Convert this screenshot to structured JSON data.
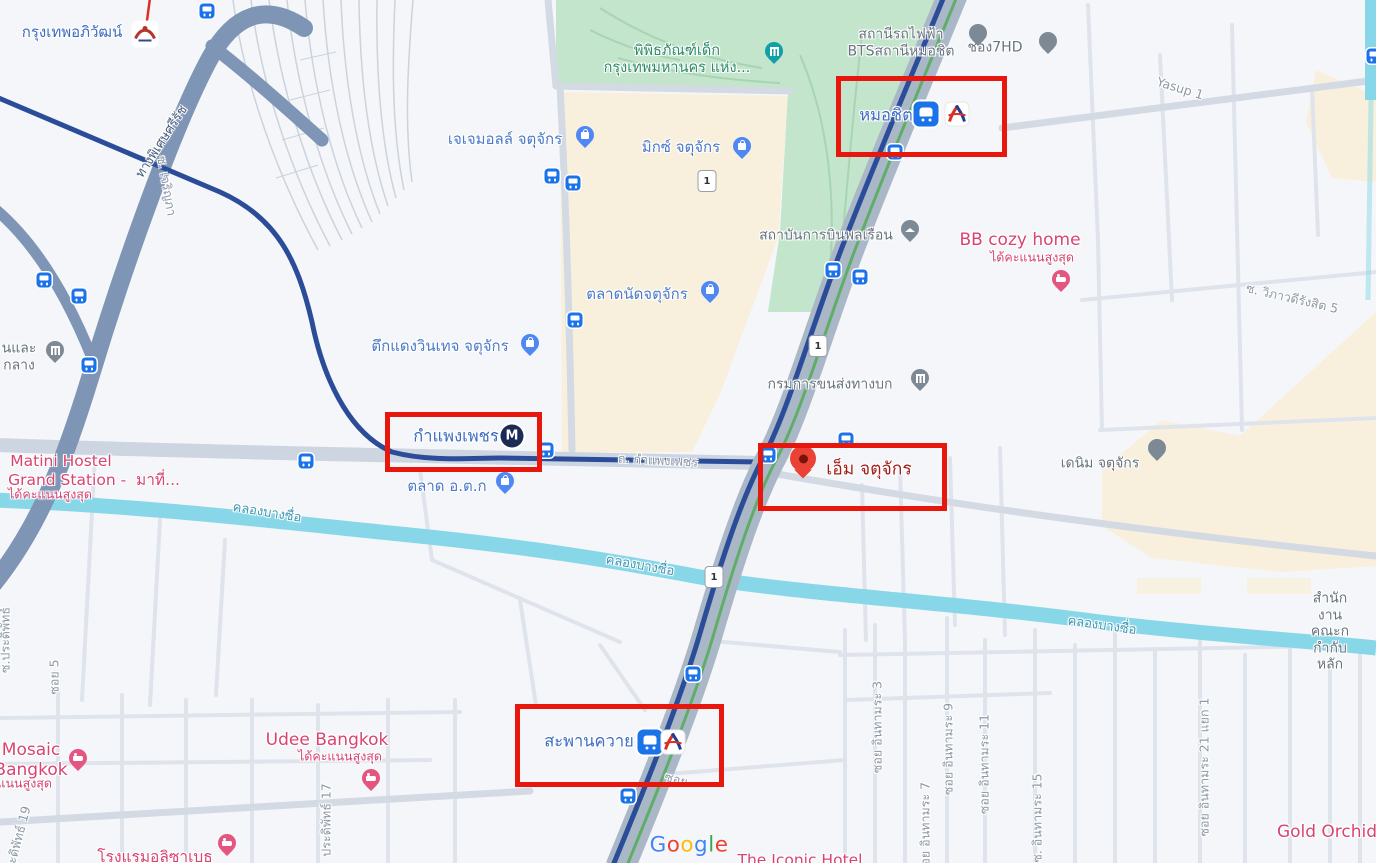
{
  "map": {
    "app": "Google Maps",
    "colors": {
      "annotation_red": "#e8170d",
      "water": "#87d7e8",
      "park_green": "#c2e5cb",
      "market_beige": "#f8f0dc",
      "transit_corridor": "#aab7c7",
      "metro_line": "#2b4d99",
      "bts_green_track": "#5fae67",
      "expressway": "#7e95b5",
      "poi_blue": "#4c7ac6",
      "poi_gray": "#67737e",
      "hotel_pink": "#d84471",
      "selected_pin_red": "#ea4335",
      "bus_stop_blue": "#1a73e8"
    },
    "google_logo": {
      "letters": [
        {
          "ch": "G",
          "color": "#4285F4"
        },
        {
          "ch": "o",
          "color": "#EA4335"
        },
        {
          "ch": "o",
          "color": "#FBBC05"
        },
        {
          "ch": "g",
          "color": "#4285F4"
        },
        {
          "ch": "l",
          "color": "#34A853"
        },
        {
          "ch": "e",
          "color": "#EA4335"
        }
      ]
    },
    "labels": [
      {
        "name": "label-krung-thep-aphiwat-station",
        "text": "กรุงเทพอภิวัฒน์",
        "x": 72,
        "y": 33,
        "cls": "sta15",
        "interact": true
      },
      {
        "name": "label-bts-mochit-station-poi",
        "text": "สถานีรถไฟฟ้า\nBTSสถานีหมอชิต",
        "x": 901,
        "y": 43,
        "cls": "gray",
        "interact": true
      },
      {
        "name": "label-channel-7hd",
        "text": "ช่อง7HD",
        "x": 995,
        "y": 48,
        "cls": "gray",
        "interact": true
      },
      {
        "name": "label-children-museum",
        "text": "พิพิธภัณฑ์เด็ก\nกรุงเทพมหานคร แห่ง...",
        "x": 677,
        "y": 60,
        "cls": "park",
        "interact": true
      },
      {
        "name": "label-yasup-1-road",
        "text": "Yasup 1",
        "x": 1180,
        "y": 89,
        "cls": "road",
        "rot": 17,
        "interact": false
      },
      {
        "name": "label-mochit-bts",
        "text": "หมอชิต",
        "x": 886,
        "y": 115,
        "cls": "sta16",
        "interact": true
      },
      {
        "name": "label-expressway-si-rat",
        "text": "ทางพิเศษศรีรัช",
        "x": 162,
        "y": 142,
        "cls": "exp",
        "rot": -57,
        "interact": false
      },
      {
        "name": "label-jj-mall",
        "text": "เจเจมอลล์ จตุจักร",
        "x": 505,
        "y": 140,
        "cls": "shop",
        "interact": true
      },
      {
        "name": "label-mixt-chatuchak",
        "text": "มิกซ์ จตุจักร",
        "x": 681,
        "y": 148,
        "cls": "shop",
        "interact": true
      },
      {
        "name": "label-soi-charoenpha",
        "text": "ซ. เจริญภา",
        "x": 166,
        "y": 186,
        "cls": "road",
        "rot": 80,
        "interact": false
      },
      {
        "name": "label-civil-aviation-institute",
        "text": "สถาบันการบินพลเรือน",
        "x": 826,
        "y": 236,
        "cls": "gray",
        "interact": true
      },
      {
        "name": "label-bb-cozy-home",
        "text": "BB cozy home",
        "x": 1020,
        "y": 240,
        "cls": "pink17",
        "interact": true
      },
      {
        "name": "label-bb-cozy-home-rating",
        "text": "ได้คะแนนสูงสุด",
        "x": 1032,
        "y": 258,
        "cls": "pinksub",
        "interact": false
      },
      {
        "name": "label-chatuchak-weekend-market",
        "text": "ตลาดนัดจตุจักร",
        "x": 637,
        "y": 295,
        "cls": "shop",
        "interact": true
      },
      {
        "name": "label-soi-wiphawadi-rangsit-5",
        "text": "ซ. วิภาวดีรังสิต 5",
        "x": 1292,
        "y": 299,
        "cls": "road",
        "rot": 13,
        "interact": false
      },
      {
        "name": "label-tuk-daeng-vintage",
        "text": "ตึกแดงวินเทจ จตุจักร",
        "x": 440,
        "y": 347,
        "cls": "shop",
        "interact": true
      },
      {
        "name": "label-bank-truncated",
        "text": "นและ\nกลาง",
        "x": 19,
        "y": 357,
        "cls": "gray",
        "interact": false
      },
      {
        "name": "label-dept-land-transport",
        "text": "กรมการขนส่งทางบก",
        "x": 830,
        "y": 385,
        "cls": "gray",
        "interact": true
      },
      {
        "name": "label-kamphaeng-phet-mrt",
        "text": "กำแพงเพชร",
        "x": 456,
        "y": 436,
        "cls": "sta16",
        "interact": true
      },
      {
        "name": "label-denim-chatuchak",
        "text": "เดนิม จตุจักร",
        "x": 1100,
        "y": 464,
        "cls": "gray",
        "interact": true
      },
      {
        "name": "label-kamphaeng-phet-road",
        "text": "ถ. กำแพงเพชร",
        "x": 658,
        "y": 461,
        "cls": "road",
        "rot": 3,
        "interact": false
      },
      {
        "name": "label-m-chatuchak",
        "text": "เอ็ม จตุจักร",
        "x": 869,
        "y": 470,
        "cls": "darkred",
        "interact": true
      },
      {
        "name": "label-matini-hostel-line1",
        "text": "Matini Hostel",
        "x": 61,
        "y": 461,
        "cls": "pink16",
        "interact": true
      },
      {
        "name": "label-matini-hostel-line2",
        "text": "Grand Station -  มาที่...",
        "x": 94,
        "y": 480,
        "cls": "pink16",
        "interact": true
      },
      {
        "name": "label-matini-hostel-rating",
        "text": "ได้คะแนนสูงสุด",
        "x": 50,
        "y": 495,
        "cls": "pinksub",
        "interact": false
      },
      {
        "name": "label-or-tor-kor-market",
        "text": "ตลาด อ.ต.ก",
        "x": 447,
        "y": 487,
        "cls": "shop",
        "interact": true
      },
      {
        "name": "label-khlong-bang-sue-1",
        "text": "คลองบางซื่อ",
        "x": 267,
        "y": 513,
        "cls": "canal",
        "rot": 9,
        "interact": false
      },
      {
        "name": "label-khlong-bang-sue-2",
        "text": "คลองบางซื่อ",
        "x": 640,
        "y": 566,
        "cls": "canal",
        "rot": 10,
        "interact": false
      },
      {
        "name": "label-khlong-bang-sue-3",
        "text": "คลองบางซื่อ",
        "x": 1102,
        "y": 626,
        "cls": "canal",
        "rot": 8,
        "interact": false
      },
      {
        "name": "label-sec-office-truncated",
        "text": "สำนักงานคณะก\nกำกับหลัก",
        "x": 1330,
        "y": 632,
        "cls": "gray",
        "interact": true
      },
      {
        "name": "label-soi-pradipat-left",
        "text": "ซ.ประดิพัทธ์",
        "x": 6,
        "y": 640,
        "cls": "road",
        "rot": -90,
        "interact": false
      },
      {
        "name": "label-soi-5",
        "text": "ซอย 5",
        "x": 55,
        "y": 677,
        "cls": "road",
        "rot": -90,
        "interact": false
      },
      {
        "name": "label-udee-bangkok",
        "text": "Udee Bangkok",
        "x": 327,
        "y": 740,
        "cls": "pink17",
        "interact": true
      },
      {
        "name": "label-udee-bangkok-rating",
        "text": "ได้คะแนนสูงสุด",
        "x": 340,
        "y": 757,
        "cls": "pinksub",
        "interact": false
      },
      {
        "name": "label-saphan-khwai-bts",
        "text": "สะพานควาย",
        "x": 589,
        "y": 741,
        "cls": "sta16",
        "interact": true
      },
      {
        "name": "label-mosaic-bangkok",
        "text": "Mosaic\nBangkok",
        "x": 31,
        "y": 760,
        "cls": "pink17",
        "interact": true
      },
      {
        "name": "label-mosaic-bangkok-rating",
        "text": "ได้คะแนนสูงสุด",
        "x": 10,
        "y": 784,
        "cls": "pinksub",
        "interact": false
      },
      {
        "name": "label-soi-partial",
        "text": "ซอย",
        "x": 676,
        "y": 780,
        "cls": "road",
        "rot": 15,
        "interact": false
      },
      {
        "name": "label-soi-inthamara-3",
        "text": "ซอย อินทามระ 3",
        "x": 878,
        "y": 727,
        "cls": "road",
        "rot": -90,
        "interact": false
      },
      {
        "name": "label-soi-inthamara-7",
        "text": "ซอย อินทามระ 7",
        "x": 926,
        "y": 828,
        "cls": "road",
        "rot": -90,
        "interact": false
      },
      {
        "name": "label-soi-inthamara-9",
        "text": "ซอย อินทามระ 9",
        "x": 949,
        "y": 749,
        "cls": "road",
        "rot": -90,
        "interact": false
      },
      {
        "name": "label-soi-inthamara-11",
        "text": "ซอย อินทามระ 11",
        "x": 985,
        "y": 764,
        "cls": "road",
        "rot": -90,
        "interact": false
      },
      {
        "name": "label-soi-inthamara-15",
        "text": "ซ. อินทามระ 15",
        "x": 1038,
        "y": 818,
        "cls": "road",
        "rot": -90,
        "interact": false
      },
      {
        "name": "label-soi-inthamara-21-yaek-1",
        "text": "ซอย อินทามระ 21 แยก 1",
        "x": 1205,
        "y": 767,
        "cls": "road",
        "rot": -90,
        "interact": false
      },
      {
        "name": "label-pradipat-17",
        "text": "ประดิพัทธ์ 17",
        "x": 327,
        "y": 820,
        "cls": "road",
        "rot": -90,
        "interact": false
      },
      {
        "name": "label-pradipat-19",
        "text": "ซ.ประดิพัทธ์ 19",
        "x": 16,
        "y": 848,
        "cls": "road",
        "rot": -75,
        "interact": false
      },
      {
        "name": "label-elizabeth-hotel",
        "text": "โรงแรมอลิซาเบธ",
        "x": 155,
        "y": 857,
        "cls": "pink16",
        "interact": true
      },
      {
        "name": "label-the-iconic-hotel",
        "text": "The Iconic Hotel",
        "x": 800,
        "y": 860,
        "cls": "pink16",
        "interact": true
      },
      {
        "name": "label-gold-orchid",
        "text": "Gold Orchid",
        "x": 1327,
        "y": 832,
        "cls": "pink17",
        "interact": true
      }
    ],
    "pins": [
      {
        "kind": "bag",
        "name": "jj-mall-pin",
        "x": 585,
        "y": 137,
        "color": "#4f87f5"
      },
      {
        "kind": "bag",
        "name": "mixt-chatuchak-pin",
        "x": 742,
        "y": 148,
        "color": "#4f87f5"
      },
      {
        "kind": "bag",
        "name": "tuk-daeng-pin",
        "x": 530,
        "y": 345,
        "color": "#4f87f5"
      },
      {
        "kind": "cart",
        "name": "chatuchak-market-pin",
        "x": 710,
        "y": 292,
        "color": "#4f87f5"
      },
      {
        "kind": "cart",
        "name": "or-tor-kor-pin",
        "x": 505,
        "y": 483,
        "color": "#4f87f5"
      },
      {
        "kind": "bed",
        "name": "bb-cozy-home-pin",
        "x": 1061,
        "y": 281,
        "color": "#e4567f"
      },
      {
        "kind": "bed",
        "name": "udee-bangkok-pin",
        "x": 371,
        "y": 780,
        "color": "#e4567f"
      },
      {
        "kind": "bed",
        "name": "mosaic-bangkok-pin",
        "x": 78,
        "y": 760,
        "color": "#e4567f"
      },
      {
        "kind": "bed",
        "name": "elizabeth-hotel-pin",
        "x": 227,
        "y": 845,
        "color": "#e4567f"
      },
      {
        "kind": "bldg",
        "name": "dept-land-transport-pin",
        "x": 920,
        "y": 380,
        "color": "#7d8a96"
      },
      {
        "kind": "bldg",
        "name": "bank-pin",
        "x": 55,
        "y": 352,
        "color": "#7d8a96"
      },
      {
        "kind": "plain",
        "name": "channel-7hd-pin",
        "x": 1048,
        "y": 43,
        "color": "#7d8a96"
      },
      {
        "kind": "plain",
        "name": "bts-mochit-poi-pin",
        "x": 978,
        "y": 35,
        "color": "#7d8a96"
      },
      {
        "kind": "plain",
        "name": "denim-chatuchak-pin",
        "x": 1157,
        "y": 450,
        "color": "#7d8a96"
      },
      {
        "kind": "grad",
        "name": "civil-aviation-pin",
        "x": 910,
        "y": 231,
        "color": "#7d8a96"
      },
      {
        "kind": "bldg",
        "name": "children-museum-pin",
        "x": 774,
        "y": 53,
        "color": "#11a0a8"
      },
      {
        "kind": "red",
        "name": "m-chatuchak-selected-pin",
        "x": 803,
        "y": 462,
        "color": "#ea4335"
      }
    ],
    "station_badges": [
      {
        "kind": "train",
        "name": "mochit-train-icon",
        "x": 926,
        "y": 114
      },
      {
        "kind": "bts",
        "name": "mochit-bts-logo",
        "x": 957,
        "y": 114
      },
      {
        "kind": "train",
        "name": "saphan-khwai-train-icon",
        "x": 650,
        "y": 742
      },
      {
        "kind": "bts",
        "name": "saphan-khwai-bts-logo",
        "x": 673,
        "y": 742
      },
      {
        "kind": "mrt",
        "name": "kamphaeng-phet-mrt-logo",
        "x": 512,
        "y": 436,
        "letter": "M"
      },
      {
        "kind": "srt",
        "name": "krung-thep-aphiwat-srt-logo",
        "x": 145,
        "y": 34
      }
    ],
    "bus_stops": [
      [
        207,
        11
      ],
      [
        44,
        280
      ],
      [
        79,
        296
      ],
      [
        89,
        365
      ],
      [
        306,
        461
      ],
      [
        552,
        176
      ],
      [
        573,
        183
      ],
      [
        575,
        320
      ],
      [
        833,
        270
      ],
      [
        860,
        277
      ],
      [
        546,
        450
      ],
      [
        768,
        455
      ],
      [
        846,
        440
      ],
      [
        895,
        152
      ],
      [
        693,
        674
      ],
      [
        628,
        796
      ],
      [
        1374,
        56
      ]
    ],
    "route_shields": [
      {
        "label": "1",
        "x": 707,
        "y": 181
      },
      {
        "label": "1",
        "x": 818,
        "y": 346
      },
      {
        "label": "1",
        "x": 714,
        "y": 577
      }
    ],
    "annotation_boxes": [
      {
        "name": "annotation-box-mochit",
        "x": 836,
        "y": 76,
        "w": 161,
        "h": 71
      },
      {
        "name": "annotation-box-kamphaeng-phet",
        "x": 385,
        "y": 412,
        "w": 147,
        "h": 50
      },
      {
        "name": "annotation-box-m-chatuchak",
        "x": 758,
        "y": 443,
        "w": 179,
        "h": 58
      },
      {
        "name": "annotation-box-saphan-khwai",
        "x": 515,
        "y": 704,
        "w": 199,
        "h": 73
      }
    ]
  }
}
